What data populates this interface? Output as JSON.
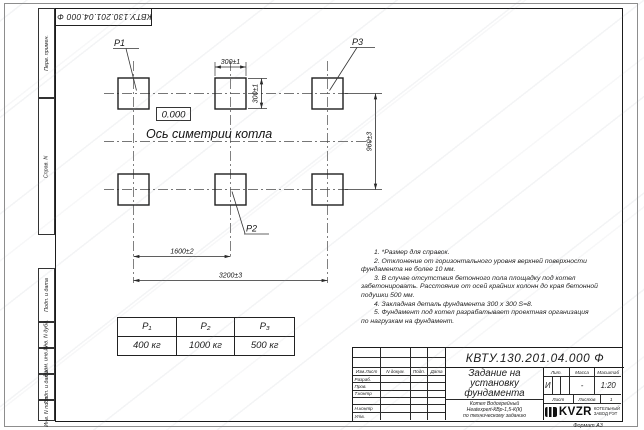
{
  "sheet": {
    "top_stamp": "КВТУ.130.201.04.000 Ф",
    "format_note": "Формат А3",
    "side_fields": [
      "Перв. примен.",
      "Справ. N",
      "Подп. и дата",
      "Инв. N дубл.",
      "Взам. инв. N",
      "Подп. и дата",
      "Инв. N подл."
    ]
  },
  "drawing": {
    "point_labels": {
      "p1": "P1",
      "p2": "P2",
      "p3": "P3"
    },
    "elevation": "0.000",
    "axis_label": "Ось симетрии котла",
    "dims": {
      "pad_width": "300±1",
      "pad_height": "300±1",
      "row_gap": "960±3",
      "half_span": "1600±2",
      "full_span": "3200±3"
    }
  },
  "notes": {
    "lines": [
      "1. *Размер для справок.",
      "2. Отклонение от горизонтального уровня верхней поверхности",
      "фундамента не более 10 мм.",
      "3. В случае отсутствия бетонного пола площадку под котел",
      "забетонировать. Расстояние от осей крайних колонн до края бетонной",
      "подушки 500 мм.",
      "4. Закладная деталь фундамента 300 x 300 S=8.",
      "5. Фундамент под котел разрабатывает проектная организация",
      "по нагрузкам на фундамент."
    ]
  },
  "load_table": {
    "headers": [
      "P₁",
      "P₂",
      "P₃"
    ],
    "values": [
      "400 кг",
      "1000 кг",
      "500 кг"
    ]
  },
  "title_block": {
    "designation": "КВТУ.130.201.04.000 Ф",
    "title_lines": [
      "Задание на",
      "установку",
      "фундамента"
    ],
    "subject_lines": [
      "Котел Водогрейный",
      "Heatexpert-КВр-1,5-К(К)",
      "по техническому заданию"
    ],
    "col_headers": [
      "Изм.Лист",
      "N докум.",
      "Подп.",
      "Дата"
    ],
    "row_labels": [
      "Разраб.",
      "Пров.",
      "Т.контр",
      "",
      "Н.контр",
      "Утв."
    ],
    "lit_label": "Лит.",
    "lit_value": "И",
    "mass_label": "Масса",
    "mass_value": "-",
    "scale_label": "Масштаб",
    "scale_value": "1:20",
    "sheet_label": "Лист",
    "sheets_label": "Листов",
    "sheets_count": "1",
    "logo_text": "KVZR",
    "company_lines": [
      "КОТЕЛЬНЫЙ",
      "ЗАВОД РЭТ"
    ]
  }
}
